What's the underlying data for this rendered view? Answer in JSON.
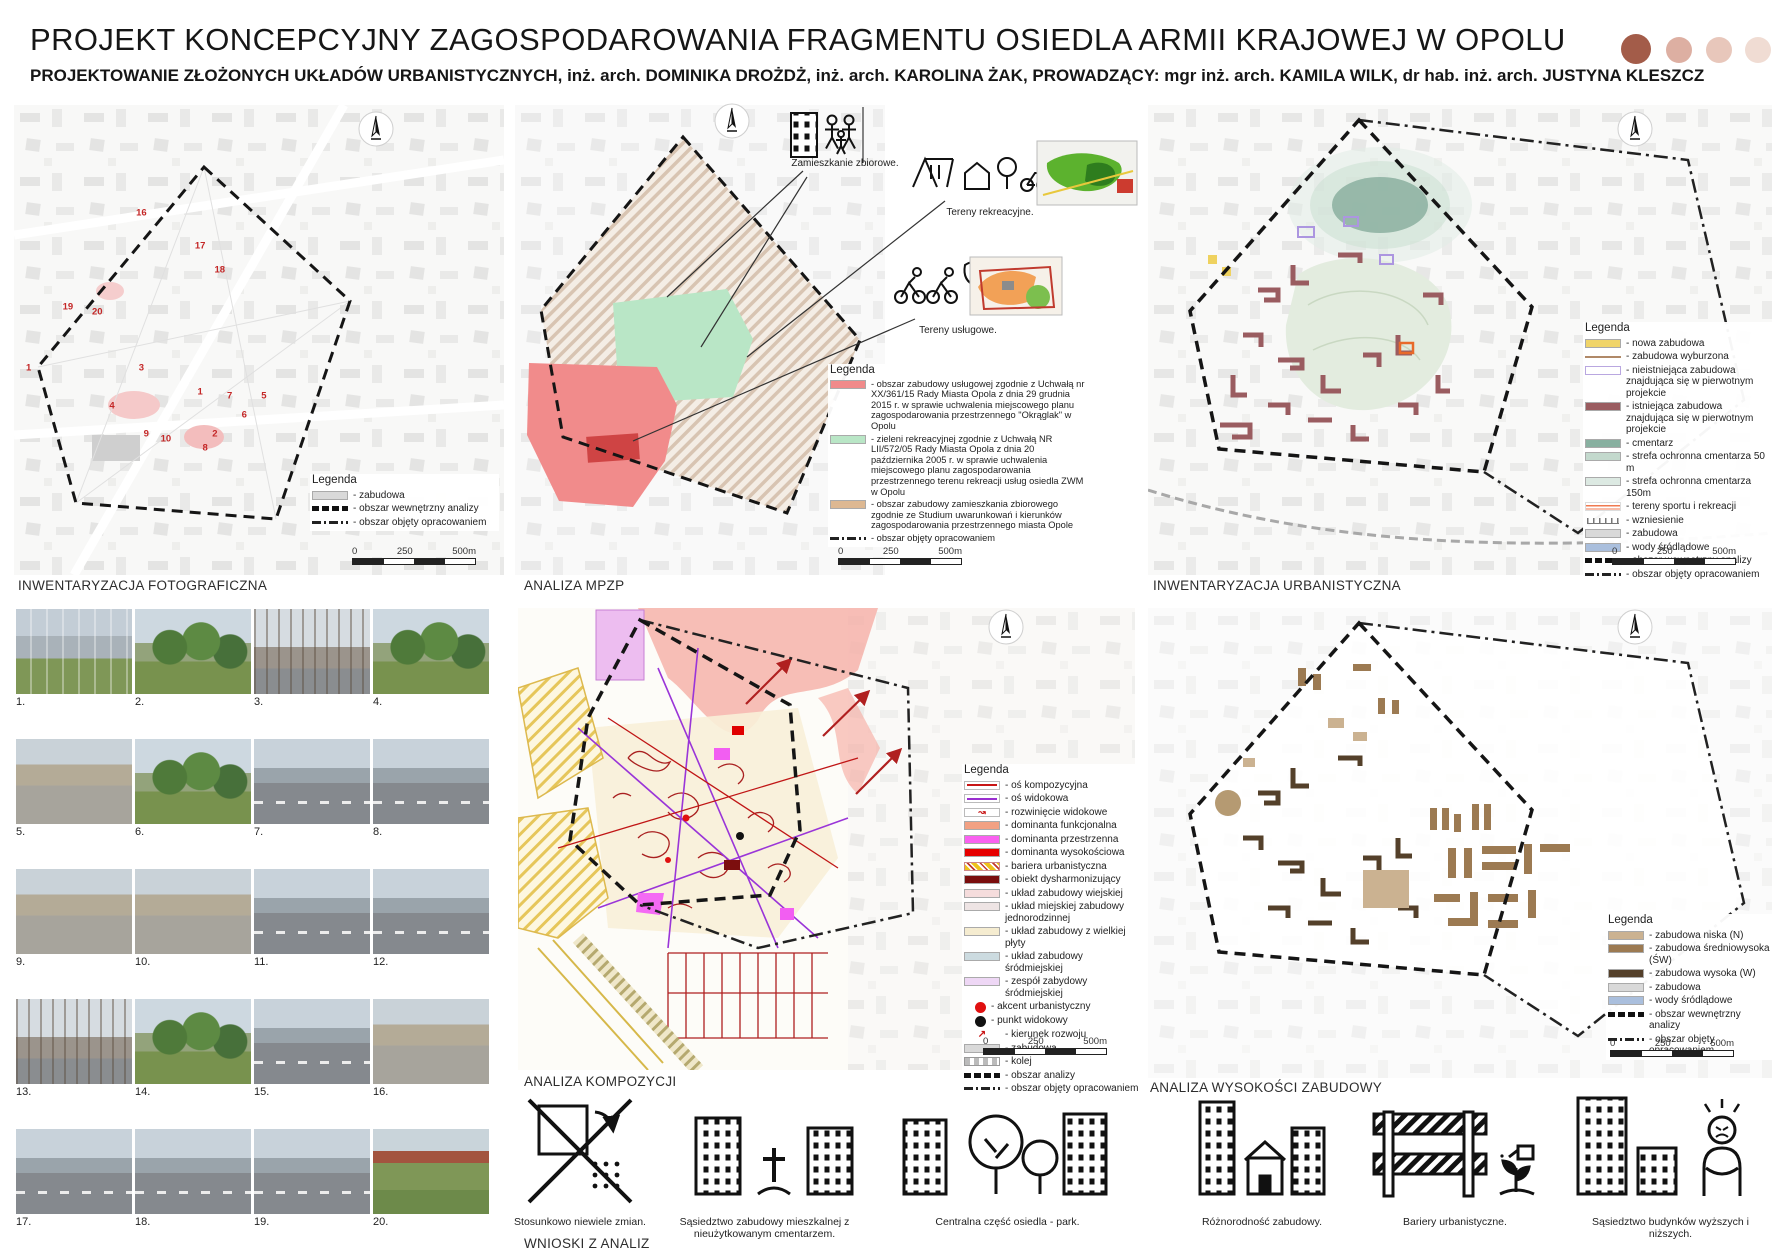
{
  "header": {
    "title": "PROJEKT KONCEPCYJNY ZAGOSPODAROWANIA FRAGMENTU OSIEDLA ARMII KRAJOWEJ W OPOLU",
    "subtitle": "PROJEKTOWANIE ZŁOŻONYCH UKŁADÓW URBANISTYCZNYCH, inż. arch. DOMINIKA DROŻDŻ, inż. arch. KAROLINA ŻAK, PROWADZĄCY: mgr inż. arch. KAMILA WILK, dr hab. inż. arch. JUSTYNA KLESZCZ",
    "palette_dots": [
      "#a35c49",
      "#ddafa2",
      "#e8c7bb",
      "#f0dcd3"
    ]
  },
  "legend_title": "Legenda",
  "scalebar": {
    "start": "0",
    "mid": "250",
    "end": "500m"
  },
  "maps": {
    "photo": {
      "title": "INWENTARYZACJA FOTOGRAFICZNA",
      "legend": [
        {
          "label": "- zabudowa",
          "type": "fill",
          "color": "#d9d9d9"
        },
        {
          "label": "- obszar wewnętrzny analizy",
          "type": "dashbold",
          "color": "#111111"
        },
        {
          "label": "- obszar objęty opracowaniem",
          "type": "dashdot",
          "color": "#333333"
        }
      ],
      "points": [
        {
          "n": "16",
          "x": 26,
          "y": 23
        },
        {
          "n": "17",
          "x": 38,
          "y": 30
        },
        {
          "n": "18",
          "x": 42,
          "y": 35
        },
        {
          "n": "19",
          "x": 11,
          "y": 43
        },
        {
          "n": "20",
          "x": 17,
          "y": 44
        },
        {
          "n": "1",
          "x": 3,
          "y": 56
        },
        {
          "n": "3",
          "x": 26,
          "y": 56
        },
        {
          "n": "1",
          "x": 38,
          "y": 61
        },
        {
          "n": "7",
          "x": 44,
          "y": 62
        },
        {
          "n": "5",
          "x": 51,
          "y": 62
        },
        {
          "n": "4",
          "x": 20,
          "y": 64
        },
        {
          "n": "6",
          "x": 47,
          "y": 66
        },
        {
          "n": "9",
          "x": 27,
          "y": 70
        },
        {
          "n": "10",
          "x": 31,
          "y": 71
        },
        {
          "n": "2",
          "x": 41,
          "y": 70
        },
        {
          "n": "8",
          "x": 39,
          "y": 73
        }
      ]
    },
    "mpzp": {
      "title": "ANALIZA MPZP",
      "callouts": {
        "zbiorowe": "Zamieszkanie zbiorowe.",
        "rekreacyjne": "Tereny rekreacyjne.",
        "uslugowe": "Tereny usługowe."
      },
      "legend": [
        {
          "label": "- obszar zabudowy usługowej zgodnie z Uchwałą nr XX/361/15 Rady Miasta Opola z dnia 29 grudnia 2015 r. w sprawie uchwalenia miejscowego planu zagospodarowania przestrzennego \"Okrąglak\" w Opolu",
          "type": "fill",
          "color": "#f08a8a"
        },
        {
          "label": "- zieleni rekreacyjnej zgodnie z Uchwałą NR LII/572/05 Rady Miasta Opola z dnia 20 października 2005 r. w sprawie uchwalenia miejscowego planu zagospodarowania przestrzennego terenu rekreacji usług osiedla ZWM w Opolu",
          "type": "fill",
          "color": "#b9e6c6"
        },
        {
          "label": "- obszar zabudowy zamieszkania zbiorowego zgodnie ze Studium uwarunkowań i kierunków zagospodarowania przestrzennego miasta Opole",
          "type": "fill",
          "color": "#ddb892"
        },
        {
          "label": "- obszar objęty opracowaniem",
          "type": "dashdot",
          "color": "#333333"
        }
      ]
    },
    "urban": {
      "title": "INWENTARYZACJA URBANISTYCZNA",
      "legend": [
        {
          "label": "- nowa zabudowa",
          "type": "fill",
          "color": "#f0d469"
        },
        {
          "label": "- zabudowa wyburzona",
          "type": "line",
          "color": "#b08968"
        },
        {
          "label": "- nieistniejąca zabudowa znajdująca się w pierwotnym projekcie",
          "type": "outline",
          "color": "#b9a7e0"
        },
        {
          "label": "- istniejąca zabudowa znajdująca się w pierwotnym projekcie",
          "type": "fill",
          "color": "#9a5c60"
        },
        {
          "label": "- cmentarz",
          "type": "fill",
          "color": "#88b0a0"
        },
        {
          "label": "- strefa ochronna cmentarza 50 m",
          "type": "fill",
          "color": "#c3d9cd"
        },
        {
          "label": "- strefa ochronna cmentarza 150m",
          "type": "fill",
          "color": "#dce9e2"
        },
        {
          "label": "- tereny sportu  i rekreacji",
          "type": "stripes",
          "color": "#f07a50"
        },
        {
          "label": "- wzniesienie",
          "type": "contour",
          "color": "#777777"
        },
        {
          "label": "- zabudowa",
          "type": "fill",
          "color": "#d9d9d9"
        },
        {
          "label": "- wody śródlądowe",
          "type": "fill",
          "color": "#aabfdd"
        },
        {
          "label": "- obszar wewnętrzny analizy",
          "type": "dashbold",
          "color": "#111111"
        },
        {
          "label": "- obszar objęty opracowaniem",
          "type": "dashdot",
          "color": "#333333"
        }
      ]
    },
    "composition": {
      "title": "ANALIZA KOMPOZYCJI",
      "legend": [
        {
          "label": "- oś kompozycyjna",
          "type": "linebox",
          "color": "#c81515"
        },
        {
          "label": "- oś widokowa",
          "type": "linebox",
          "color": "#9a2fd0"
        },
        {
          "label": "- rozwinięcie widokowe",
          "type": "view",
          "color": "#c81515"
        },
        {
          "label": "- dominanta funkcjonalna",
          "type": "fill",
          "color": "#f2a183"
        },
        {
          "label": "- dominanta przestrzenna",
          "type": "fill",
          "color": "#f961f0"
        },
        {
          "label": "- dominanta wysokościowa",
          "type": "fill",
          "color": "#e60000"
        },
        {
          "label": "- bariera urbanistyczna",
          "type": "hatch",
          "color": "#e8b800"
        },
        {
          "label": "- obiekt dysharmonizujący",
          "type": "fill",
          "color": "#7a0d0d"
        },
        {
          "label": "- układ zabudowy wiejskiej",
          "type": "fill",
          "color": "#f5dcdc"
        },
        {
          "label": "- układ miejskiej zabudowy jednorodzinnej",
          "type": "fill",
          "color": "#eee4e4"
        },
        {
          "label": "- układ zabudowy z wielkiej płyty",
          "type": "fill",
          "color": "#f5ecd0"
        },
        {
          "label": "- układ zabudowy  śródmiejskiej",
          "type": "fill",
          "color": "#ccdbe0"
        },
        {
          "label": "- zespół zabydowy śródmiejskiej",
          "type": "fill",
          "color": "#eed7f5"
        },
        {
          "label": "- akcent urbanistyczny",
          "type": "circle",
          "color": "#e01010"
        },
        {
          "label": "- punkt widokowy",
          "type": "circle",
          "color": "#111111"
        },
        {
          "label": "- kierunek rozwoju",
          "type": "arrow",
          "color": "#c81515"
        },
        {
          "label": "- zabudowa",
          "type": "fill",
          "color": "#d9d9d9"
        },
        {
          "label": "- kolej",
          "type": "rail",
          "color": "#bbbbbb"
        },
        {
          "label": "- obszar analizy",
          "type": "dashbold",
          "color": "#111111"
        },
        {
          "label": "- obszar objęty opracowaniem",
          "type": "dashdot",
          "color": "#333333"
        }
      ]
    },
    "heights": {
      "title": "ANALIZA WYSOKOŚCI ZABUDOWY",
      "legend": [
        {
          "label": "- zabudowa niska (N)",
          "type": "fill",
          "color": "#cbb291"
        },
        {
          "label": "- zabudowa średniowysoka (ŚW)",
          "type": "fill",
          "color": "#9c7a52"
        },
        {
          "label": "- zabudowa wysoka (W)",
          "type": "fill",
          "color": "#54402a"
        },
        {
          "label": "- zabudowa",
          "type": "fill",
          "color": "#d9d9d9"
        },
        {
          "label": "- wody śródlądowe",
          "type": "fill",
          "color": "#aabfdd"
        },
        {
          "label": "- obszar wewnętrzny analizy",
          "type": "dashbold",
          "color": "#111111"
        },
        {
          "label": "- obszar objęty opracowaniem",
          "type": "dashdot",
          "color": "#333333"
        }
      ]
    }
  },
  "photos": [
    {
      "label": "1.",
      "look": "a"
    },
    {
      "label": "2.",
      "look": "b"
    },
    {
      "label": "3.",
      "look": "e"
    },
    {
      "label": "4.",
      "look": "b"
    },
    {
      "label": "5.",
      "look": "d"
    },
    {
      "label": "6.",
      "look": "b"
    },
    {
      "label": "7.",
      "look": "c"
    },
    {
      "label": "8.",
      "look": "c"
    },
    {
      "label": "9.",
      "look": "d"
    },
    {
      "label": "10.",
      "look": "d"
    },
    {
      "label": "11.",
      "look": "c"
    },
    {
      "label": "12.",
      "look": "c"
    },
    {
      "label": "13.",
      "look": "e"
    },
    {
      "label": "14.",
      "look": "b"
    },
    {
      "label": "15.",
      "look": "c"
    },
    {
      "label": "16.",
      "look": "d"
    },
    {
      "label": "17.",
      "look": "c"
    },
    {
      "label": "18.",
      "look": "c"
    },
    {
      "label": "19.",
      "look": "c"
    },
    {
      "label": "20.",
      "look": "f"
    }
  ],
  "conclusions": {
    "title": "WNIOSKI Z ANALIZ",
    "items": {
      "changes": "Stosunkowo niewiele zmian.",
      "cemetery": "Sąsiedztwo zabudowy mieszkalnej z nieużytkowanym cmentarzem.",
      "park": "Centralna część osiedla - park.",
      "variety": "Różnorodność zabudowy.",
      "barriers": "Bariery urbanistyczne.",
      "heights": "Sąsiedztwo budynków wyższych i niższych."
    }
  }
}
